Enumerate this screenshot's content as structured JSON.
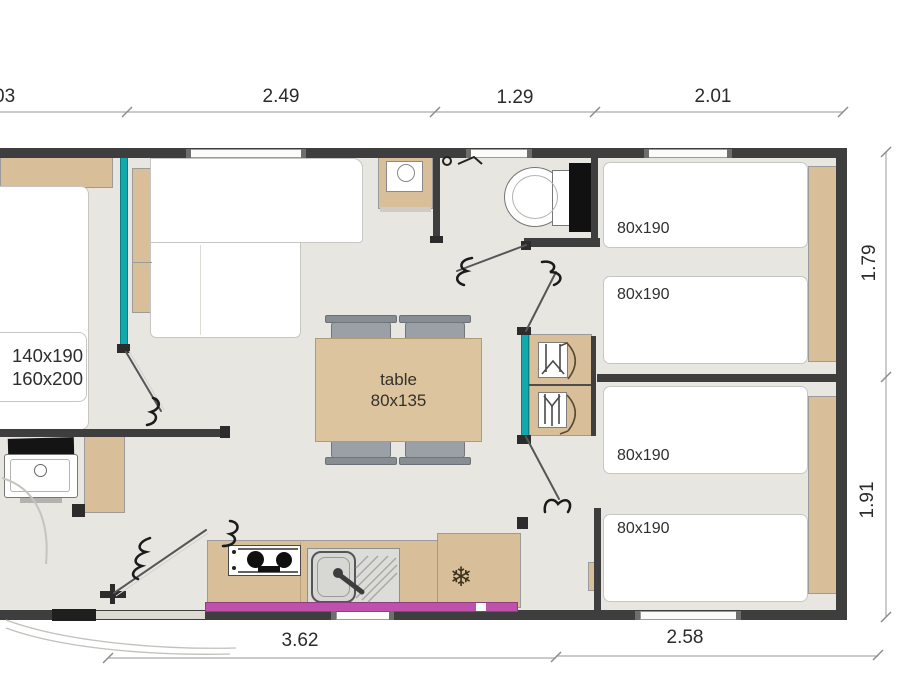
{
  "plan_type": "mobile-home floor plan",
  "colors": {
    "wall": "#3e3e3e",
    "wood": "#d8bf9a",
    "teal_partition": "#12a9ad",
    "pink_bay": "#c050ae",
    "floor": "#e8e6e1",
    "chair_gray": "#9aa0a6"
  },
  "dims": {
    "top": [
      "03",
      "2.49",
      "1.29",
      "2.01"
    ],
    "right": [
      "1.79",
      "1.91"
    ],
    "bottom": [
      "3.62",
      "2.58"
    ]
  },
  "labels": {
    "master_bed": [
      "140x190",
      "160x200"
    ],
    "table": [
      "table",
      "80x135"
    ],
    "single_beds": [
      "80x190",
      "80x190",
      "80x190",
      "80x190"
    ]
  },
  "icons": {
    "fridge_snowflake": "❄"
  }
}
